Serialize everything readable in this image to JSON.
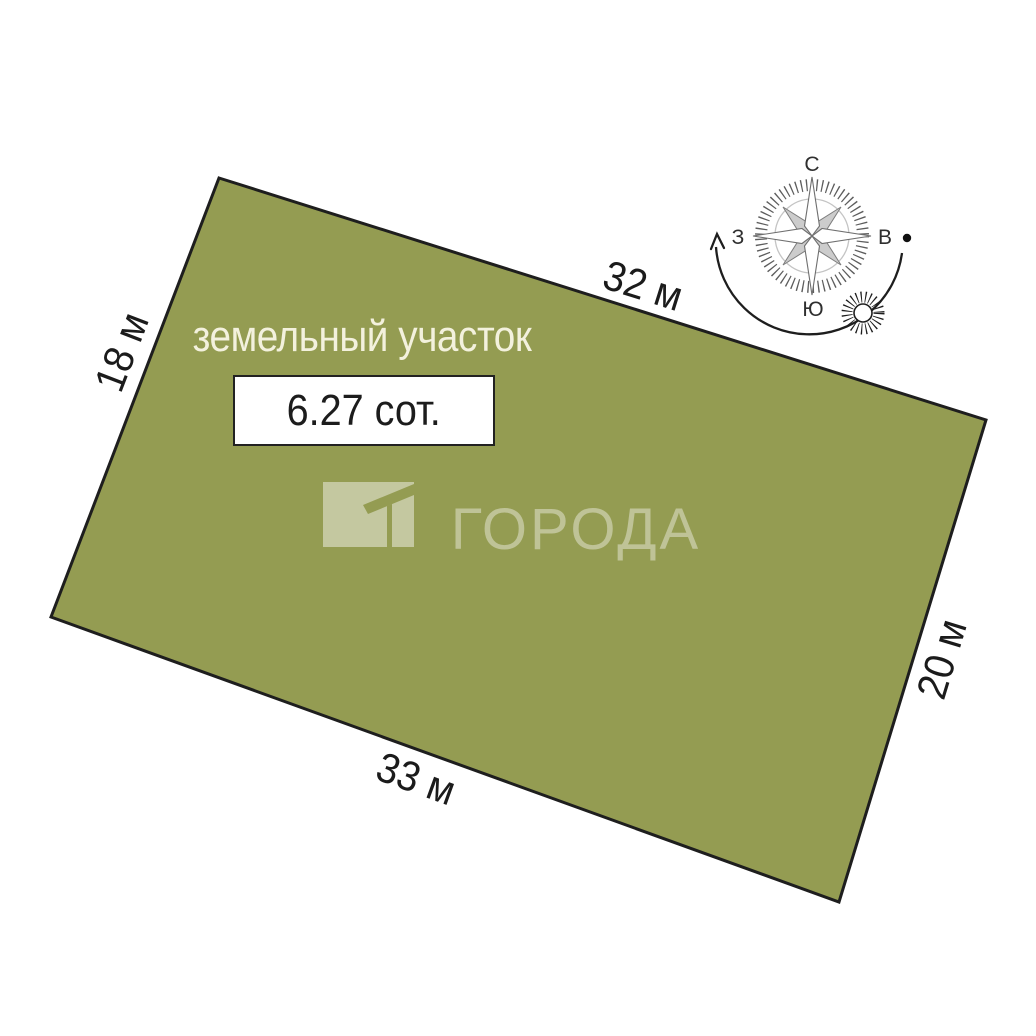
{
  "scheme": {
    "title": "земельный участок",
    "area_label": "6.27 сот."
  },
  "dimensions": {
    "top": "32 м",
    "left": "18 м",
    "right": "20 м",
    "bottom": "33 м"
  },
  "compass": {
    "north": "С",
    "south": "Ю",
    "west": "З",
    "east": "В"
  },
  "watermark": {
    "brand": "ГОРОДА"
  },
  "colors": {
    "plot_fill": "#949c52",
    "plot_border": "#1e1e1e"
  }
}
